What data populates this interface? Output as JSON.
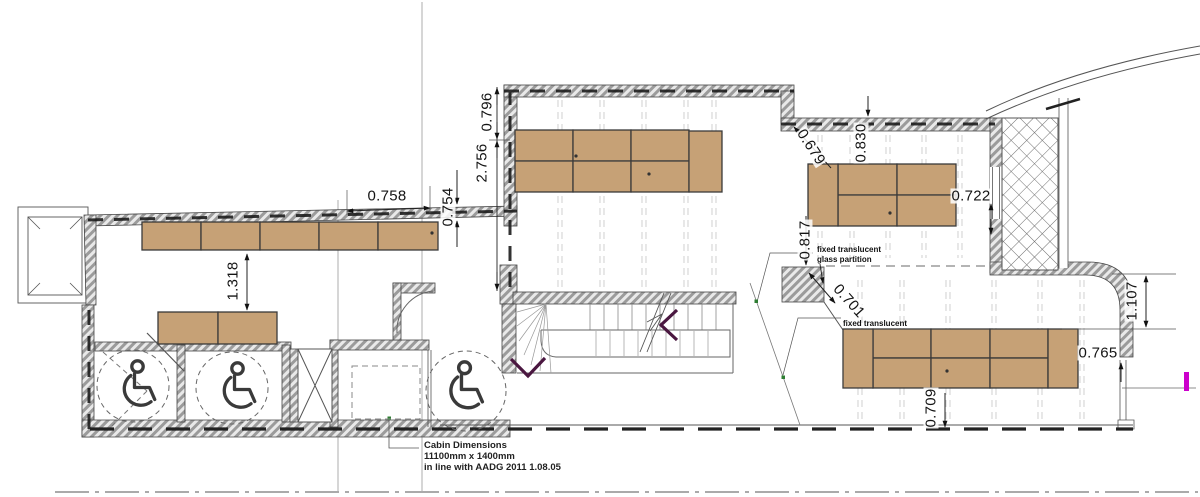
{
  "labels": {
    "dim_0758": "0.758",
    "dim_0754": "0.754",
    "dim_0796": "0.796",
    "dim_2756": "2.756",
    "dim_1318": "1.318",
    "dim_0679": "0.679",
    "dim_0830": "0.830",
    "dim_0722": "0.722",
    "dim_0817": "0.817",
    "dim_0701": "0.701",
    "dim_1107": "1.107",
    "dim_0765": "0.765",
    "dim_0709": "0.709"
  },
  "annotations": {
    "partition_upper_line1": "fixed translucent",
    "partition_upper_line2": "glass partition",
    "partition_lower": "fixed translucent",
    "cabin_line1": "Cabin Dimensions",
    "cabin_line2": "11100mm x 1400mm",
    "cabin_line3": "in line with AADG 2011 1.08.05"
  },
  "icons": {
    "wheelchair": "accessible-wc-symbol",
    "stair_arrow": "direction-chevron",
    "shaft": "crosshatch-riser"
  },
  "colors": {
    "desk_wood": "#cda97e",
    "wall_hatch": "#9b9b9b",
    "stair_arrow": "#4a1740",
    "magenta_marker": "#cc00cc",
    "green_marker": "#2e7d32"
  }
}
